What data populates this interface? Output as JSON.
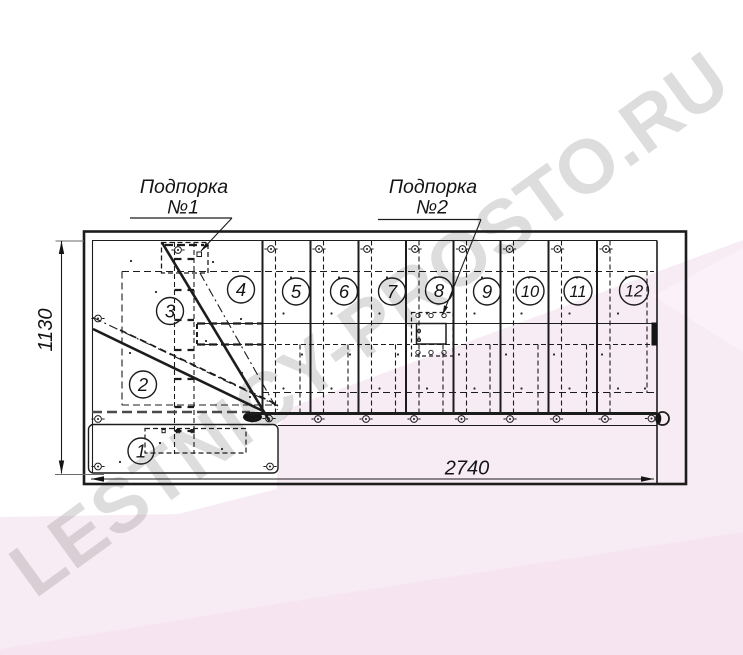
{
  "title": "Staircase plan drawing",
  "watermark": {
    "text": "LESTNICY-PROSTO.RU",
    "color": "#4a4a4a"
  },
  "annotations": {
    "support1": {
      "line1": "Подпорка",
      "line2": "№1"
    },
    "support2": {
      "line1": "Подпорка",
      "line2": "№2"
    }
  },
  "dimensions": {
    "height_label": "1130",
    "length_label": "2740"
  },
  "steps": [
    "1",
    "2",
    "3",
    "4",
    "5",
    "6",
    "7",
    "8",
    "9",
    "10",
    "11",
    "12"
  ],
  "colors": {
    "line": "#1c1c1c",
    "pink_main": "#f8ecf4",
    "pink_deep": "#f6e5f0",
    "pink_light": "#fbf1f8"
  }
}
